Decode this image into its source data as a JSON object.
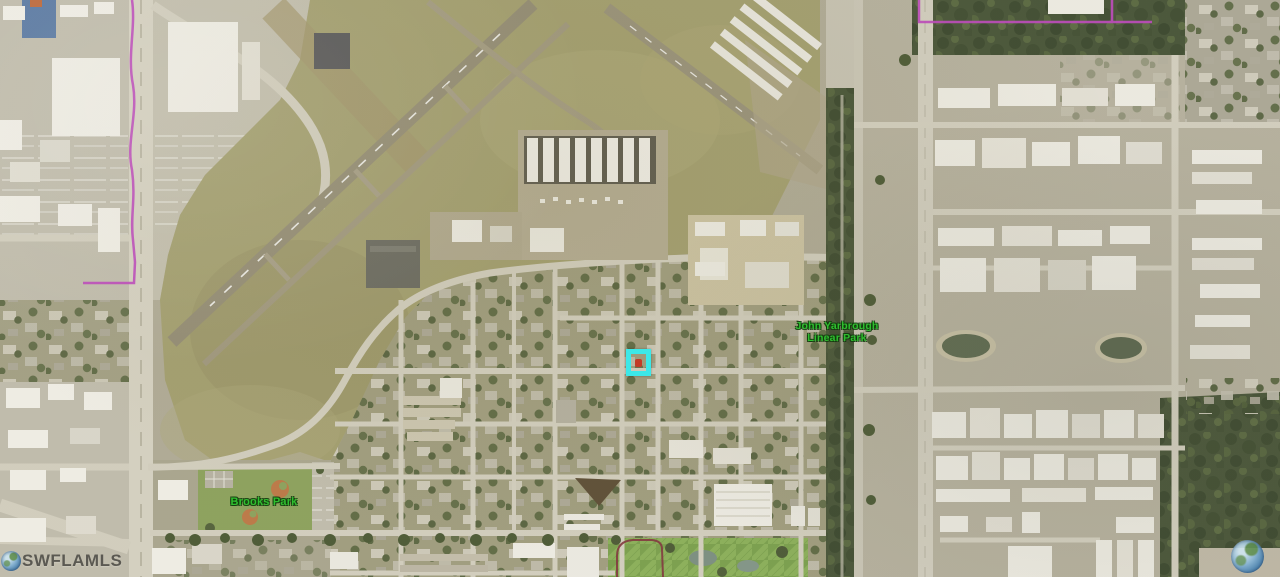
{
  "map": {
    "labels": {
      "linear_park_line1": "John Yarbrough",
      "linear_park_line2": "Linear Park",
      "brooks_park": "Brooks Park"
    },
    "watermark_text": "SWFLAMLS",
    "label_color": "#2fbf2f",
    "marker": {
      "outline_color": "#3ce8e8",
      "dot_color": "#c23b27"
    },
    "boundaries": {
      "magenta": "#bf49bf",
      "maroon": "#82353e"
    }
  }
}
